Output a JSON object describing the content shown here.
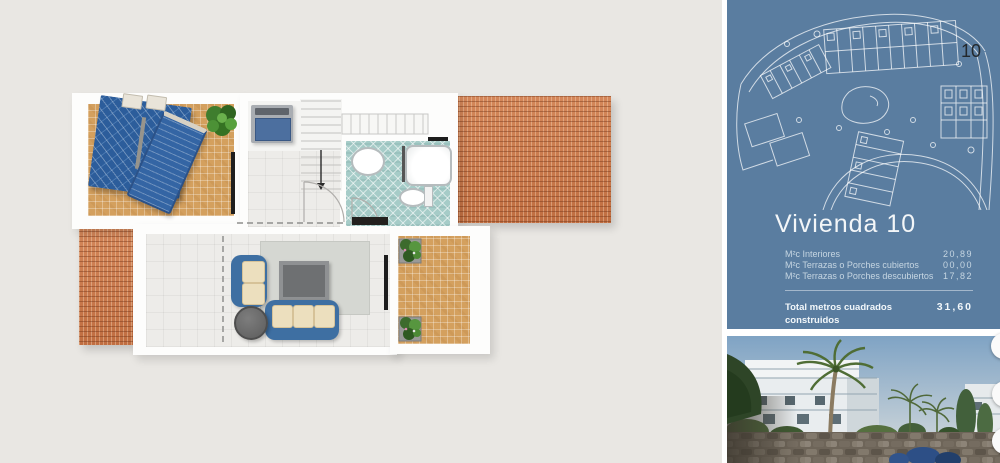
{
  "panel": {
    "siteplan_unit_label": "10",
    "title": "Vivienda 10",
    "areas": [
      {
        "label": "M²c Interiores",
        "value": "20,89"
      },
      {
        "label": "M²c Terrazas o Porches cubiertos",
        "value": "00,00"
      },
      {
        "label": "M²c Terrazas o Porches descubiertos",
        "value": "17,82"
      }
    ],
    "total_label": "Total metros cuadrados construidos",
    "total_value": "31,60"
  },
  "colors": {
    "page_background": "#e9e7e3",
    "panel_blue": "#5a7da0",
    "roof_terracotta": "#c97a4c",
    "terrace_tan": "#d4a05e",
    "bathroom_teal": "#a6ccc8",
    "sofa_blue": "#3e6fa2"
  }
}
